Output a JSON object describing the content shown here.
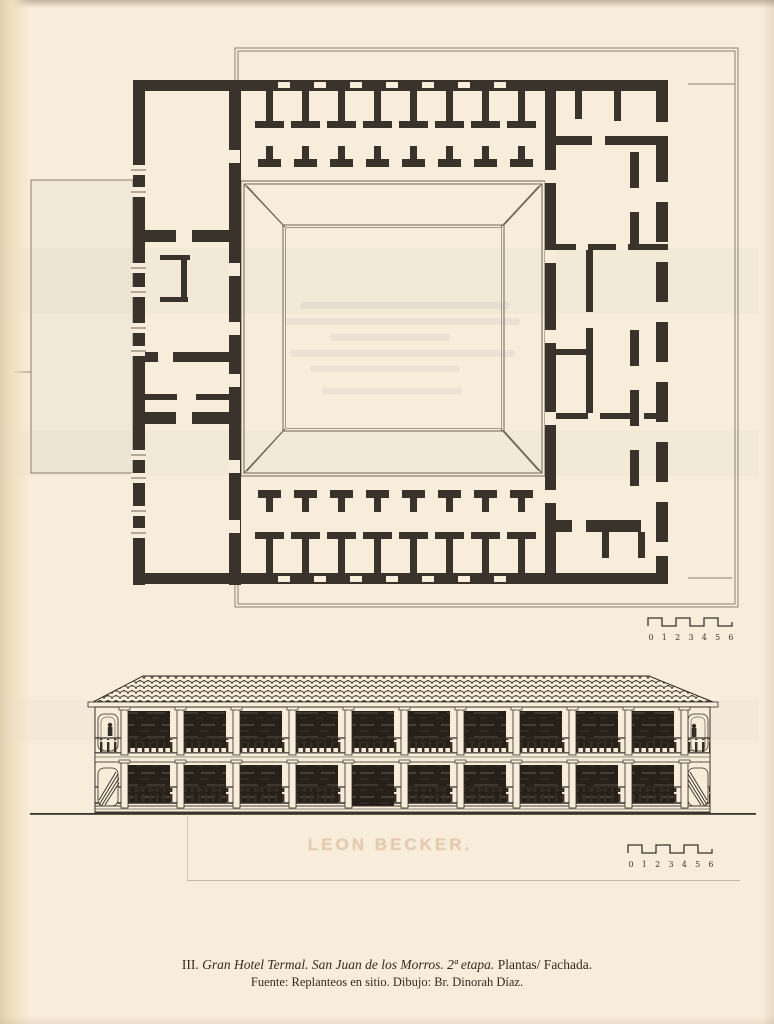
{
  "document": {
    "caption": {
      "figure_no": "III.",
      "title_italic": "Gran Hotel Termal. San Juan de los Morros. 2ª etapa.",
      "title_rest": "Plantas/ Fachada.",
      "source": "Fuente: Replanteos en sitio. Dibujo: Br. Dinorah Díaz."
    },
    "scale_bar": {
      "labels": [
        "0",
        "1",
        "2",
        "3",
        "4",
        "5",
        "6"
      ]
    },
    "bleed_through_text": "LEON BECKER.",
    "colors": {
      "paper": "#f8ecda",
      "wall_ink": "#3a332b",
      "thin_line": "#6f6557",
      "facade_ink": "#332c25",
      "bleed_text": "#ba8c64"
    }
  }
}
